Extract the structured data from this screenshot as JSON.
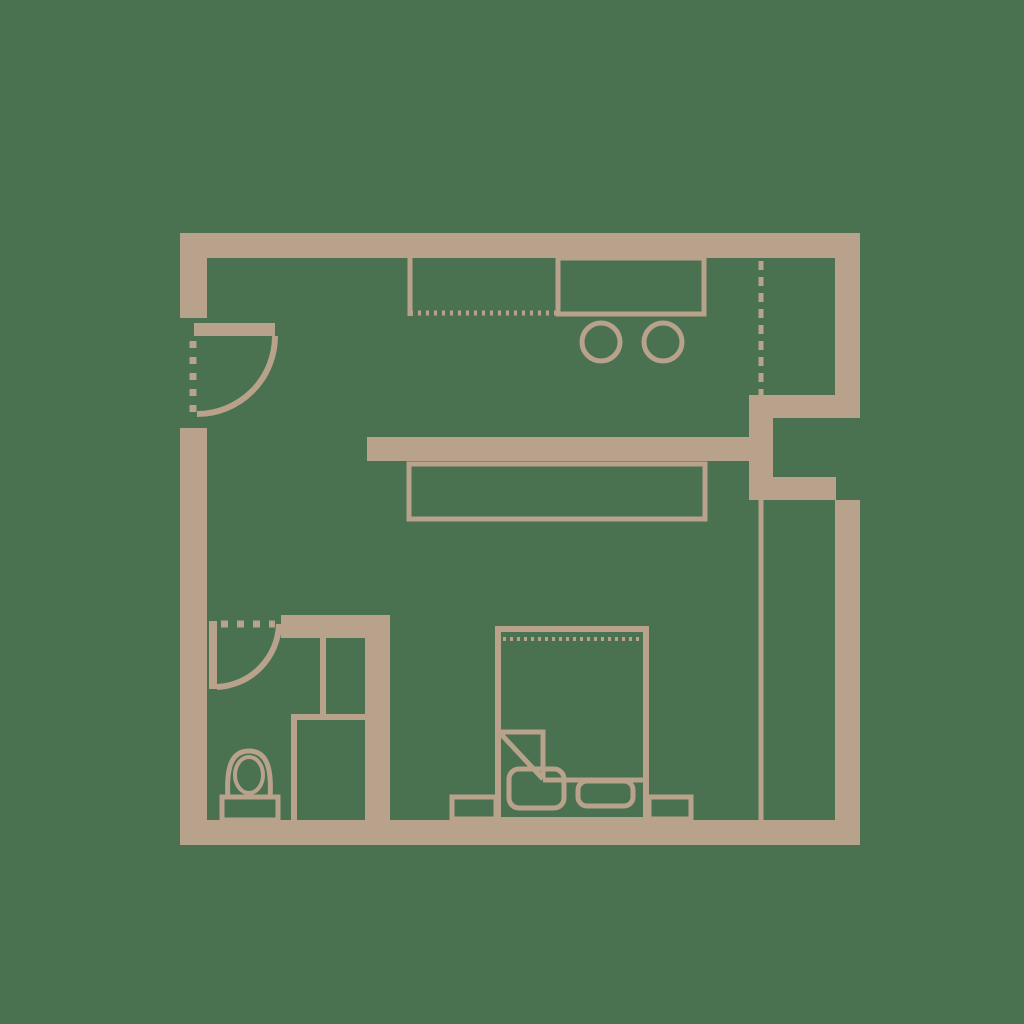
{
  "meta": {
    "description": "Studio apartment floor plan drawing, tan line-work on green background, no text labels"
  },
  "colors": {
    "background": "#4a7150",
    "wall": "#b8a28b"
  },
  "elements": {
    "walls": [
      "top-wall",
      "left-wall-upper",
      "left-wall-lower",
      "bottom-wall",
      "right-wall-upper",
      "right-wall-lower",
      "window-recess-jamb-top",
      "window-recess-jamb-bottom",
      "window-recess-connector",
      "bathroom-top-wall",
      "bathroom-partition-wall"
    ],
    "doors": [
      "entrance-door",
      "bathroom-door"
    ],
    "kitchen": [
      "counter-left-section",
      "counter-right-section",
      "burner-left",
      "burner-right",
      "kitchen-island-bar",
      "dining-table"
    ],
    "wardrobe": [
      "wardrobe-line-upper",
      "wardrobe-line-lower"
    ],
    "bathroom": [
      "toilet",
      "shower-stall",
      "bathroom-divider"
    ],
    "bedroom": [
      "double-bed",
      "headboard-dotted-line",
      "duvet-fold-corner",
      "duvet-edge-line",
      "pillow-left",
      "pillow-right",
      "nightstand-left",
      "nightstand-right"
    ]
  }
}
